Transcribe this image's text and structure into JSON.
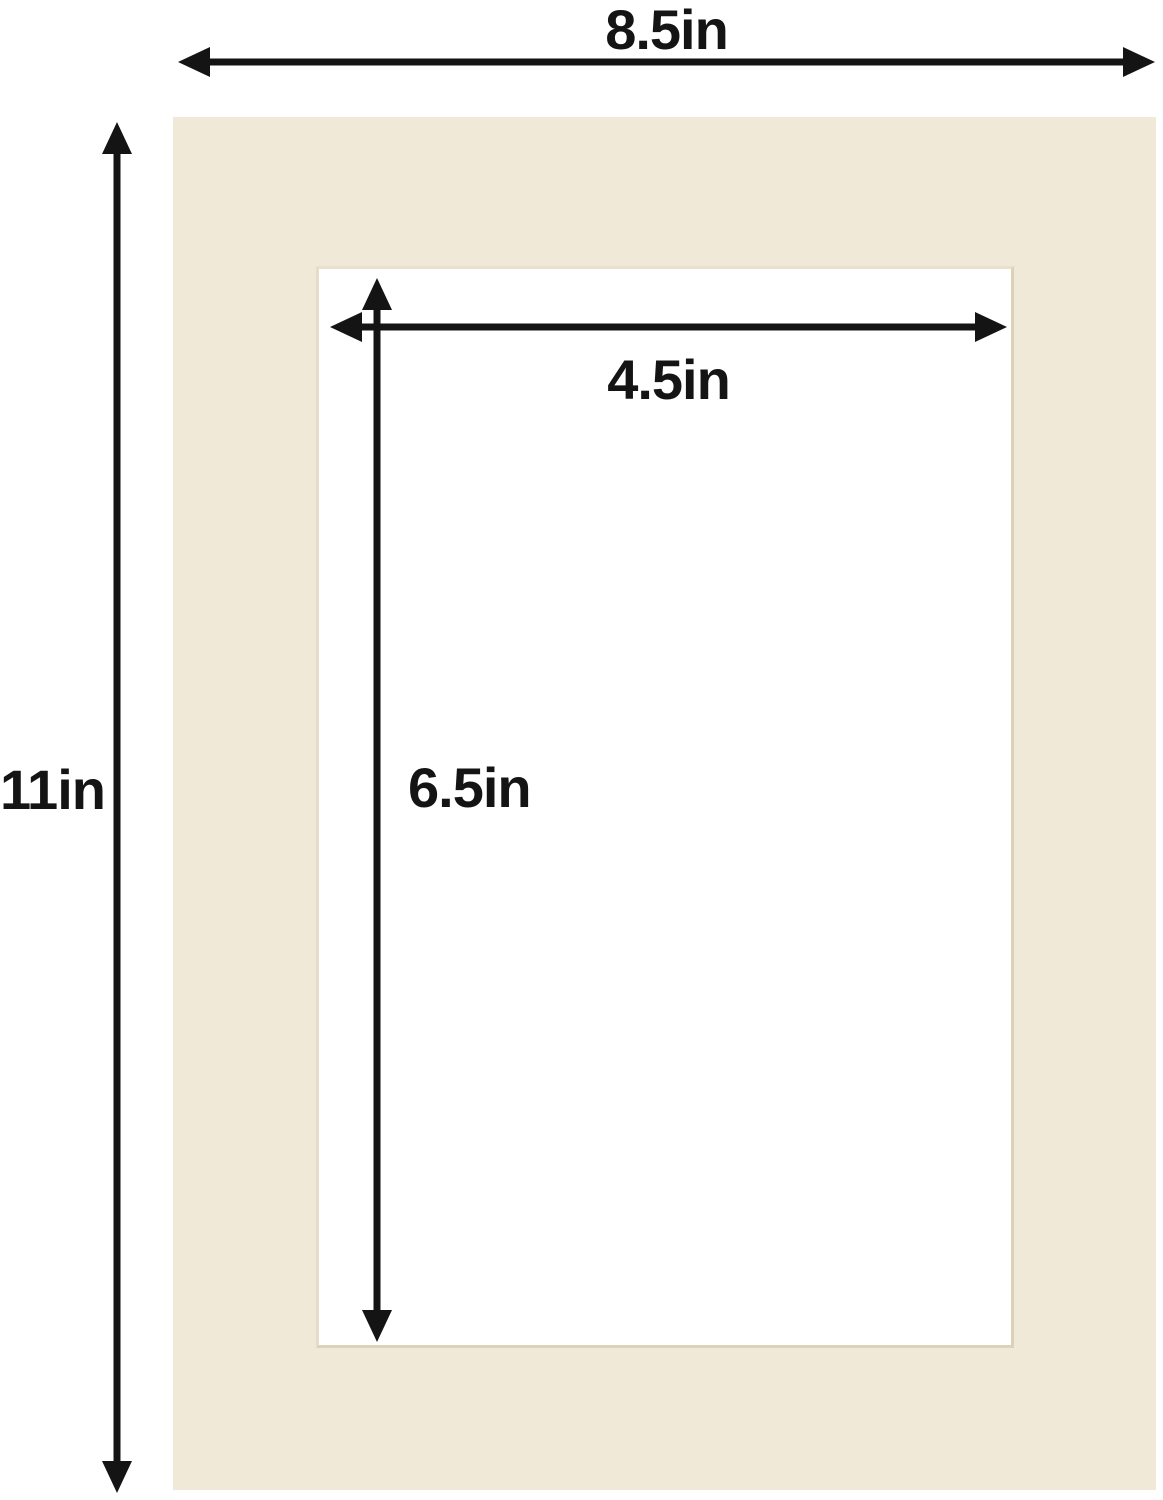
{
  "diagram": {
    "subject": "picture-frame mat board with cut window opening",
    "labels": {
      "outer_width": "8.5in",
      "outer_height": "11in",
      "opening_width": "4.5in",
      "opening_height": "6.5in"
    }
  },
  "colors": {
    "background": "#ffffff",
    "mat_board": "#f0e9d8",
    "bevel_edge": "#dcd2ba",
    "arrow": "#141414",
    "text": "#141414"
  }
}
